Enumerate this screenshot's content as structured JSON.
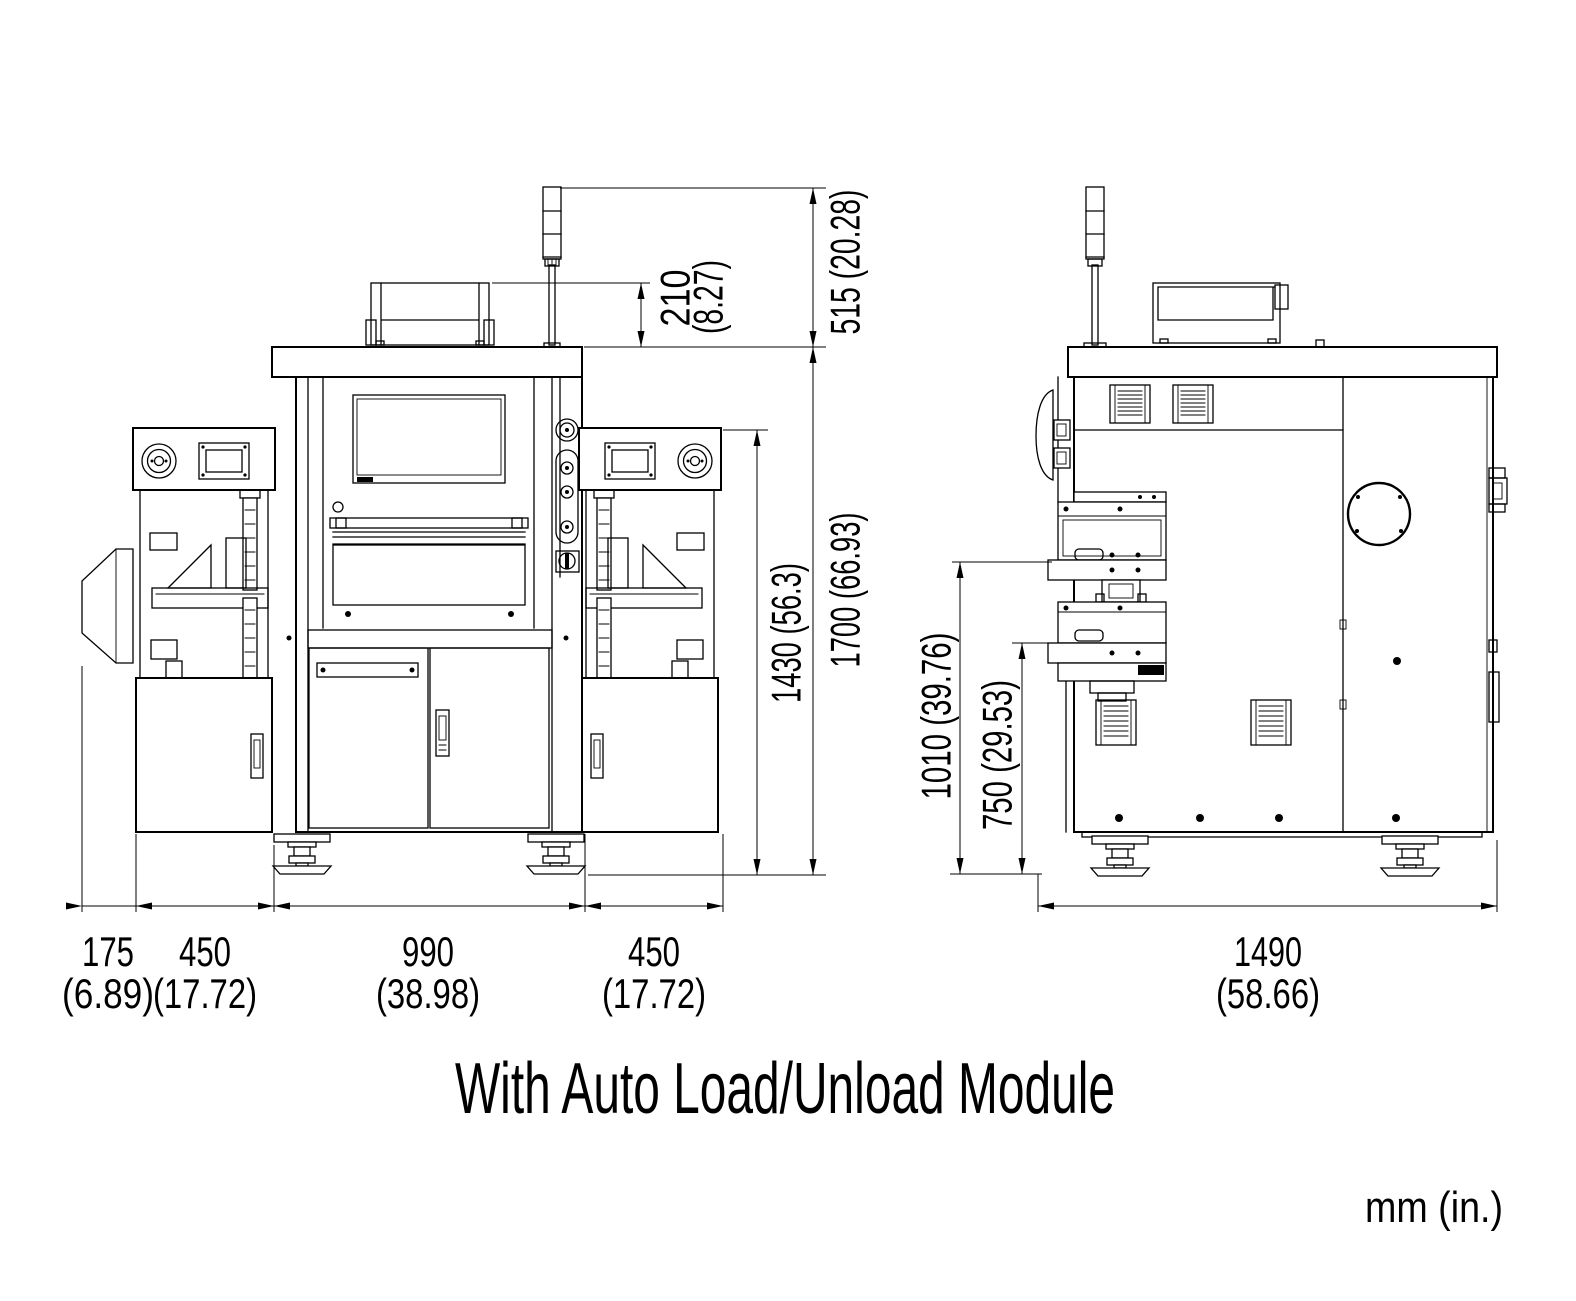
{
  "title_caption": "With Auto Load/Unload Module",
  "units_label": "mm (in.)",
  "colors": {
    "line": "#000000",
    "background": "#ffffff"
  },
  "front_view": {
    "vertical_dims": {
      "top_box_height": {
        "mm": "210",
        "in": "(8.27)"
      },
      "tower_above_top": "515 (20.28)",
      "module_top_to_floor": "1430 (56.3)",
      "cabinet_top_to_floor": "1700 (66.93)"
    },
    "width_dims": [
      {
        "mm": "175",
        "in": "(6.89)"
      },
      {
        "mm": "450",
        "in": "(17.72)"
      },
      {
        "mm": "990",
        "in": "(38.98)"
      },
      {
        "mm": "450",
        "in": "(17.72)"
      }
    ]
  },
  "side_view": {
    "vertical_dims": {
      "upper_stage_height": "1010 (39.76)",
      "lower_stage_height": "750 (29.53)"
    },
    "depth_dim": {
      "mm": "1490",
      "in": "(58.66)"
    }
  }
}
